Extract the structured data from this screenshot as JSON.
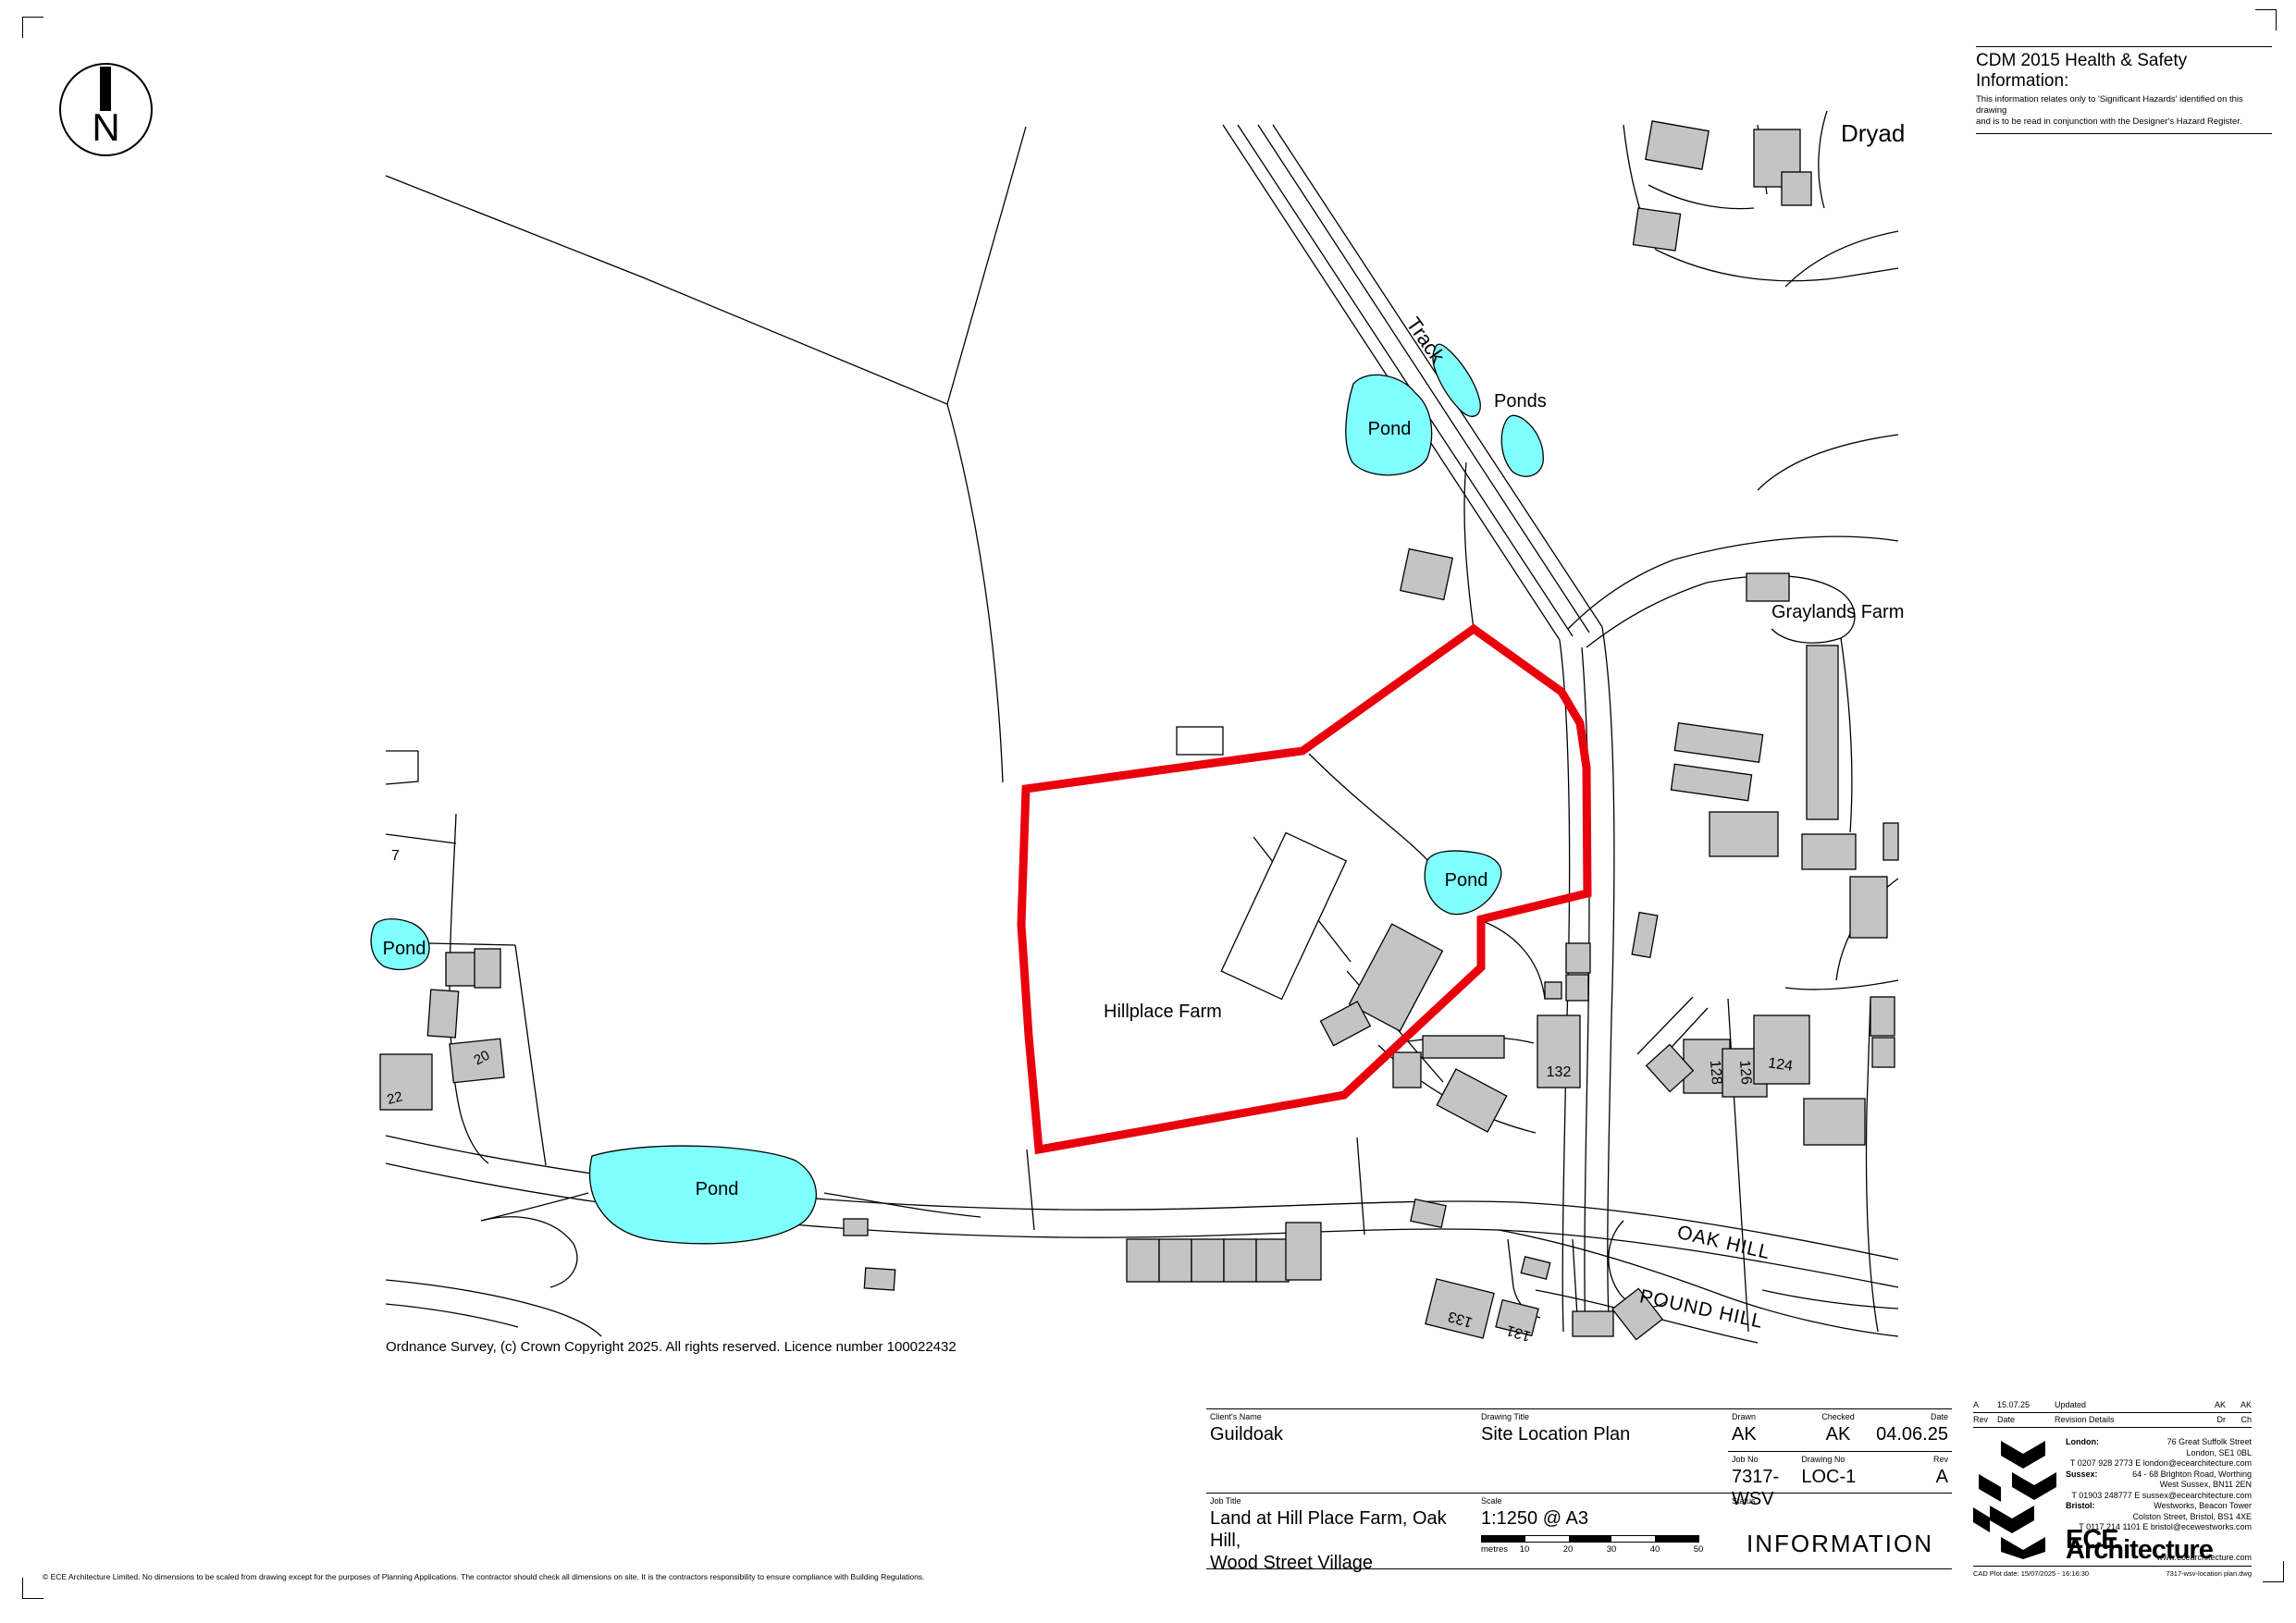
{
  "page": {
    "north_label": "N",
    "cdm": {
      "title": "CDM 2015 Health & Safety Information:",
      "body_line1": "This information relates only to 'Significant Hazards' identified on this drawing",
      "body_line2": "and is to be read in conjunction with the Designer's Hazard Register."
    },
    "os_credit": "Ordnance Survey, (c) Crown Copyright 2025. All rights reserved. Licence number 100022432",
    "footer_disclaimer": "© ECE Architecture Limited. No dimensions to be scaled from drawing except for the purposes of Planning Applications. The contractor should check all dimensions on site. It is the contractors responsibility to ensure compliance with Building Regulations."
  },
  "map": {
    "labels": {
      "dryad": "Dryad",
      "track": "Track",
      "ponds": "Ponds",
      "pond": "Pond",
      "graylands": "Graylands Farm",
      "hillplace": "Hillplace Farm",
      "oak_hill": "OAK HILL",
      "pound_hill": "POUND HILL",
      "n7": "7",
      "n20": "20",
      "n22": "22",
      "n124": "124",
      "n126": "126",
      "n128": "128",
      "n131": "131",
      "n132": "132",
      "n133": "133"
    },
    "colors": {
      "site_boundary": "#e8000d",
      "pond_fill": "#80ffff",
      "building_fill": "#c4c4c4"
    }
  },
  "titleblock": {
    "clients_name_label": "Client's Name",
    "clients_name": "Guildoak",
    "job_title_label": "Job Title",
    "job_title_line1": "Land at Hill Place Farm, Oak Hill,",
    "job_title_line2": "Wood Street Village",
    "drawing_title_label": "Drawing Title",
    "drawing_title": "Site Location Plan",
    "scale_label": "Scale",
    "scale": "1:1250 @ A3",
    "scalebar": {
      "unit": "metres",
      "ticks": [
        "10",
        "20",
        "30",
        "40",
        "50"
      ]
    },
    "drawn_label": "Drawn",
    "drawn": "AK",
    "checked_label": "Checked",
    "checked": "AK",
    "date_label": "Date",
    "date": "04.06.25",
    "job_no_label": "Job No",
    "job_no": "7317-WSV",
    "drawing_no_label": "Drawing No",
    "drawing_no": "LOC-1",
    "rev_label": "Rev",
    "rev": "A",
    "status_label": "Status",
    "status": "INFORMATION",
    "revision": {
      "rev": "A",
      "date": "15.07.25",
      "details": "Updated",
      "dr": "AK",
      "ch": "AK",
      "header": {
        "rev": "Rev",
        "date": "Date",
        "details": "Revision Details",
        "dr": "Dr",
        "ch": "Ch"
      }
    },
    "offices": [
      {
        "label": "London:",
        "lines": [
          "76 Great Suffolk Street",
          "London, SE1 0BL",
          "T 0207 928 2773  E london@ecearchitecture.com"
        ]
      },
      {
        "label": "Sussex:",
        "lines": [
          "64 - 68 Brighton Road, Worthing",
          "West Sussex, BN11 2EN",
          "T 01903 248777 E sussex@ecearchitecture.com"
        ]
      },
      {
        "label": "Bristol:",
        "lines": [
          "Westworks, Beacon Tower",
          "Colston Street, Bristol, BS1 4XE",
          "T 0117 214 1101 E bristol@ecewestworks.com"
        ]
      }
    ],
    "brand": "ECE Architecture",
    "brand_url": "www.ecearchitecture.com",
    "plot_date": "CAD Plot date:   15/07/2025 - 16:16:30",
    "file_name": "7317-wsv-location plan.dwg"
  }
}
